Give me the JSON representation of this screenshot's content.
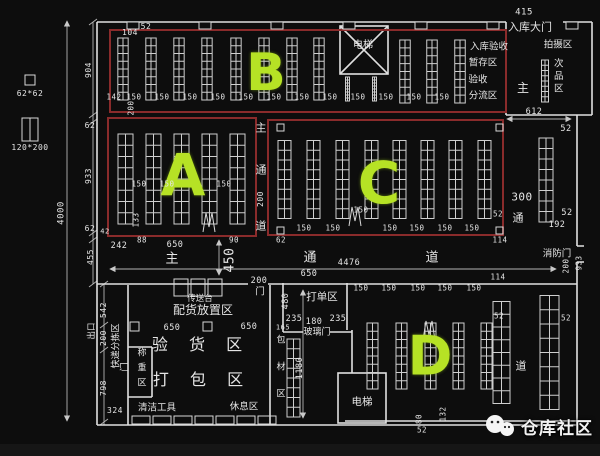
{
  "meta": {
    "description": "仓库平面图 (warehouse CAD floor plan)"
  },
  "colors": {
    "background": "#0d0d0d",
    "wall": "#e0e0e0",
    "rack": "#cfcfcf",
    "zone_border": "#8a2b2b",
    "zone_letter": "#b6e225",
    "text": "#e6e6e6"
  },
  "zones": {
    "a": "A",
    "b": "B",
    "c": "C",
    "d": "D"
  },
  "watermark": {
    "text": "仓库社区"
  },
  "legend": {
    "pillar": "62*62",
    "rack": "120*200"
  },
  "annotations": [
    {
      "n": "legend-pillar-size",
      "t": "62*62",
      "x": 30,
      "y": 94,
      "s": 8
    },
    {
      "n": "legend-rack-size",
      "t": "120*200",
      "x": 30,
      "y": 148,
      "s": 8
    },
    {
      "n": "dim-4000",
      "t": "4000",
      "x": 62,
      "y": 213,
      "r": -90,
      "s": 9
    },
    {
      "n": "dim-904",
      "t": "904",
      "x": 89,
      "y": 70,
      "r": -90,
      "s": 8
    },
    {
      "n": "dim-62-1",
      "t": "62",
      "x": 90,
      "y": 126,
      "s": 8
    },
    {
      "n": "dim-933",
      "t": "933",
      "x": 89,
      "y": 176,
      "r": -90,
      "s": 8
    },
    {
      "n": "dim-62-2",
      "t": "62",
      "x": 90,
      "y": 229,
      "s": 8
    },
    {
      "n": "dim-455",
      "t": "455",
      "x": 91,
      "y": 257,
      "r": -90,
      "s": 8
    },
    {
      "n": "dim-542",
      "t": "542",
      "x": 104,
      "y": 310,
      "r": -90,
      "s": 8
    },
    {
      "n": "dim-200-left",
      "t": "200",
      "x": 104,
      "y": 338,
      "r": -90,
      "s": 8
    },
    {
      "n": "dim-798",
      "t": "798",
      "x": 104,
      "y": 388,
      "r": -90,
      "s": 8
    },
    {
      "n": "dim-324",
      "t": "324",
      "x": 115,
      "y": 411,
      "s": 8
    },
    {
      "n": "label-exit",
      "t": "出口",
      "x": 92,
      "y": 331,
      "r": -90,
      "s": 8.5
    },
    {
      "n": "label-express-sorting-area",
      "t": "快递分拣区",
      "x": 117,
      "y": 346,
      "r": -90,
      "s": 9
    },
    {
      "n": "dim-104",
      "t": "104",
      "x": 130,
      "y": 33,
      "s": 8
    },
    {
      "n": "dim-52-top",
      "t": "52",
      "x": 146,
      "y": 27,
      "s": 8
    },
    {
      "n": "dim-415",
      "t": "415",
      "x": 524,
      "y": 13,
      "s": 9
    },
    {
      "n": "label-inbound-gate",
      "t": "入库大门",
      "x": 530,
      "y": 27,
      "s": 11
    },
    {
      "n": "label-elevator-top",
      "t": "电梯",
      "x": 363,
      "y": 46,
      "s": 10
    },
    {
      "n": "label-inbound-inspection",
      "t": "入库验收",
      "x": 489,
      "y": 47,
      "s": 9.5
    },
    {
      "n": "label-staging-area",
      "t": "暂存区",
      "x": 483,
      "y": 63,
      "s": 9.5
    },
    {
      "n": "label-inspection",
      "t": "验收",
      "x": 478,
      "y": 80,
      "s": 9.5
    },
    {
      "n": "label-distribution-area",
      "t": "分流区",
      "x": 483,
      "y": 96,
      "s": 9.5
    },
    {
      "n": "label-main-top",
      "t": "主",
      "x": 523,
      "y": 88,
      "s": 12
    },
    {
      "n": "label-photo-area",
      "t": "拍摄区",
      "x": 558,
      "y": 45,
      "s": 9.5
    },
    {
      "n": "label-defective-area",
      "t": "次品区",
      "x": 557,
      "y": 77,
      "s": 9.5,
      "v": true,
      "ls": 3
    },
    {
      "n": "dim-142",
      "t": "142",
      "x": 114,
      "y": 97,
      "s": 7.5
    },
    {
      "n": "b-150-1",
      "t": "150",
      "x": 134,
      "y": 97,
      "s": 7.5
    },
    {
      "n": "b-150-2",
      "t": "150",
      "x": 162,
      "y": 97,
      "s": 7.5
    },
    {
      "n": "b-150-3",
      "t": "150",
      "x": 190,
      "y": 97,
      "s": 7.5
    },
    {
      "n": "b-150-4",
      "t": "150",
      "x": 218,
      "y": 97,
      "s": 7.5
    },
    {
      "n": "b-150-5",
      "t": "150",
      "x": 246,
      "y": 97,
      "s": 7.5
    },
    {
      "n": "b-150-6",
      "t": "150",
      "x": 274,
      "y": 97,
      "s": 7.5
    },
    {
      "n": "b-150-7",
      "t": "150",
      "x": 302,
      "y": 97,
      "s": 7.5
    },
    {
      "n": "b-150-8",
      "t": "150",
      "x": 330,
      "y": 97,
      "s": 7.5
    },
    {
      "n": "b-150-9",
      "t": "150",
      "x": 358,
      "y": 97,
      "s": 7.5
    },
    {
      "n": "b-150-10",
      "t": "150",
      "x": 386,
      "y": 97,
      "s": 7.5
    },
    {
      "n": "b-150-11",
      "t": "150",
      "x": 414,
      "y": 97,
      "s": 7.5
    },
    {
      "n": "b-150-12",
      "t": "150",
      "x": 442,
      "y": 97,
      "s": 7.5
    },
    {
      "n": "dim-200-ba",
      "t": "200",
      "x": 131,
      "y": 108,
      "r": -90,
      "s": 7.5
    },
    {
      "n": "dim-133",
      "t": "133",
      "x": 136,
      "y": 220,
      "r": -90,
      "s": 7.5
    },
    {
      "n": "dim-42",
      "t": "42",
      "x": 105,
      "y": 232,
      "s": 7
    },
    {
      "n": "a-150-1",
      "t": "150",
      "x": 139,
      "y": 184,
      "s": 7.5
    },
    {
      "n": "a-150-2",
      "t": "150",
      "x": 167,
      "y": 184,
      "s": 7.5
    },
    {
      "n": "a-150-3",
      "t": "150",
      "x": 224,
      "y": 184,
      "s": 7.5
    },
    {
      "n": "dim-242",
      "t": "242",
      "x": 119,
      "y": 246,
      "s": 8.5
    },
    {
      "n": "dim-88",
      "t": "88",
      "x": 142,
      "y": 240,
      "s": 7.5
    },
    {
      "n": "dim-650-a",
      "t": "650",
      "x": 175,
      "y": 245,
      "s": 8.5
    },
    {
      "n": "dim-90",
      "t": "90",
      "x": 234,
      "y": 240,
      "s": 7.5
    },
    {
      "n": "dim-62-3",
      "t": "62",
      "x": 281,
      "y": 240,
      "s": 7.5
    },
    {
      "n": "dim-114-c",
      "t": "114",
      "x": 500,
      "y": 240,
      "s": 7.5
    },
    {
      "n": "label-main-aisle-zhu",
      "t": "主",
      "x": 172,
      "y": 259,
      "s": 13
    },
    {
      "n": "label-main-aisle-tong",
      "t": "通",
      "x": 310,
      "y": 258,
      "s": 13
    },
    {
      "n": "label-main-aisle-dao",
      "t": "道",
      "x": 432,
      "y": 258,
      "s": 13
    },
    {
      "n": "dim-4476",
      "t": "4476",
      "x": 349,
      "y": 263,
      "s": 8.5
    },
    {
      "n": "dim-450",
      "t": "450",
      "x": 230,
      "y": 260,
      "r": -90,
      "s": 13
    },
    {
      "n": "label-fire-door-right",
      "t": "消防门",
      "x": 557,
      "y": 254,
      "s": 9.5
    },
    {
      "n": "label-v-aisle-zhu",
      "t": "主",
      "x": 261,
      "y": 128,
      "s": 11
    },
    {
      "n": "label-v-aisle-tong",
      "t": "通",
      "x": 261,
      "y": 170,
      "s": 11
    },
    {
      "n": "dim-200-va",
      "t": "200",
      "x": 261,
      "y": 199,
      "r": -90,
      "s": 8
    },
    {
      "n": "label-v-aisle-dao",
      "t": "道",
      "x": 261,
      "y": 226,
      "s": 11
    },
    {
      "n": "c-150-1",
      "t": "150",
      "x": 304,
      "y": 228,
      "s": 7.5
    },
    {
      "n": "c-150-2",
      "t": "150",
      "x": 333,
      "y": 228,
      "s": 7.5
    },
    {
      "n": "c-150-3",
      "t": "150",
      "x": 361,
      "y": 210,
      "s": 7.5
    },
    {
      "n": "c-150-4",
      "t": "150",
      "x": 390,
      "y": 228,
      "s": 7.5
    },
    {
      "n": "c-150-5",
      "t": "150",
      "x": 417,
      "y": 228,
      "s": 7.5
    },
    {
      "n": "c-150-6",
      "t": "150",
      "x": 445,
      "y": 228,
      "s": 7.5
    },
    {
      "n": "c-150-7",
      "t": "150",
      "x": 472,
      "y": 228,
      "s": 7.5
    },
    {
      "n": "c-52",
      "t": "52",
      "x": 498,
      "y": 214,
      "s": 7.5
    },
    {
      "n": "dim-612",
      "t": "612",
      "x": 534,
      "y": 112,
      "s": 8.5
    },
    {
      "n": "dim-52-r1",
      "t": "52",
      "x": 566,
      "y": 129,
      "s": 8.5
    },
    {
      "n": "dim-300",
      "t": "300",
      "x": 522,
      "y": 197,
      "s": 11
    },
    {
      "n": "label-right-aisle-tong",
      "t": "通",
      "x": 518,
      "y": 218,
      "s": 11
    },
    {
      "n": "dim-52-r2",
      "t": "52",
      "x": 567,
      "y": 213,
      "s": 8.5
    },
    {
      "n": "dim-192",
      "t": "192",
      "x": 557,
      "y": 225,
      "s": 8.5
    },
    {
      "n": "dim-200-r",
      "t": "200",
      "x": 566,
      "y": 266,
      "r": -90,
      "s": 7.5
    },
    {
      "n": "dim-933-r",
      "t": "933",
      "x": 579,
      "y": 263,
      "r": -90,
      "s": 7.5
    },
    {
      "n": "label-conveyor",
      "t": "传送台",
      "x": 200,
      "y": 299,
      "s": 8.5
    },
    {
      "n": "label-allocation-area",
      "t": "配货放置区",
      "x": 203,
      "y": 310,
      "s": 12
    },
    {
      "n": "dim-650-b1",
      "t": "650",
      "x": 172,
      "y": 328,
      "s": 8.5
    },
    {
      "n": "dim-650-b2",
      "t": "650",
      "x": 249,
      "y": 327,
      "s": 8.5
    },
    {
      "n": "label-goods-inspection-area",
      "t": "验 货 区",
      "x": 201,
      "y": 345,
      "s": 16,
      "ls": 8
    },
    {
      "n": "label-packing-area",
      "t": "打 包 区",
      "x": 202,
      "y": 380,
      "s": 16,
      "ls": 8
    },
    {
      "n": "label-weigh-door",
      "t": "门",
      "x": 126,
      "y": 367,
      "r": -90,
      "s": 9
    },
    {
      "n": "label-weighing-area",
      "t": "称重区",
      "x": 140,
      "y": 370,
      "s": 9,
      "v": true,
      "ls": 6
    },
    {
      "n": "label-cleaning-tools",
      "t": "清洁工具",
      "x": 157,
      "y": 408,
      "s": 9.5
    },
    {
      "n": "label-rest-area",
      "t": "休息区",
      "x": 244,
      "y": 407,
      "s": 9.5
    },
    {
      "n": "dim-200-door",
      "t": "200",
      "x": 259,
      "y": 281,
      "s": 8.5
    },
    {
      "n": "label-door-main",
      "t": "门",
      "x": 260,
      "y": 292,
      "s": 9.5
    },
    {
      "n": "dim-650-c",
      "t": "650",
      "x": 309,
      "y": 274,
      "s": 8.5
    },
    {
      "n": "label-order-printing-area",
      "t": "打单区",
      "x": 322,
      "y": 297,
      "s": 10.5
    },
    {
      "n": "dim-480",
      "t": "480",
      "x": 286,
      "y": 301,
      "r": -90,
      "s": 8.5
    },
    {
      "n": "dim-235-1",
      "t": "235",
      "x": 294,
      "y": 319,
      "s": 8.5
    },
    {
      "n": "dim-180",
      "t": "180",
      "x": 314,
      "y": 322,
      "s": 8.5
    },
    {
      "n": "dim-235-2",
      "t": "235",
      "x": 338,
      "y": 319,
      "s": 8.5
    },
    {
      "n": "dim-165",
      "t": "165",
      "x": 283,
      "y": 328,
      "s": 7
    },
    {
      "n": "label-glass-door",
      "t": "玻璃门",
      "x": 317,
      "y": 333,
      "s": 9
    },
    {
      "n": "label-packing-material-area",
      "t": "包材区",
      "x": 279,
      "y": 375,
      "s": 9,
      "v": true,
      "ls": 18
    },
    {
      "n": "dim-1180",
      "t": "1180",
      "x": 300,
      "y": 368,
      "r": -90,
      "s": 8.5
    },
    {
      "n": "label-elevator-bottom",
      "t": "电梯",
      "x": 362,
      "y": 402,
      "s": 10.5
    },
    {
      "n": "d-150-1",
      "t": "150",
      "x": 361,
      "y": 288,
      "s": 7.5
    },
    {
      "n": "d-150-2",
      "t": "150",
      "x": 389,
      "y": 288,
      "s": 7.5
    },
    {
      "n": "d-150-3",
      "t": "150",
      "x": 418,
      "y": 288,
      "s": 7.5
    },
    {
      "n": "d-150-4",
      "t": "150",
      "x": 445,
      "y": 288,
      "s": 7.5
    },
    {
      "n": "d-150-5",
      "t": "150",
      "x": 474,
      "y": 288,
      "s": 7.5
    },
    {
      "n": "dim-114-d",
      "t": "114",
      "x": 498,
      "y": 277,
      "s": 7.5
    },
    {
      "n": "dim-52-d1",
      "t": "52",
      "x": 499,
      "y": 316,
      "s": 7.5
    },
    {
      "n": "dim-52-d2",
      "t": "52",
      "x": 566,
      "y": 318,
      "s": 7.5
    },
    {
      "n": "label-right-aisle-dao",
      "t": "道",
      "x": 521,
      "y": 366,
      "s": 11
    },
    {
      "n": "dim-80",
      "t": "80",
      "x": 419,
      "y": 419,
      "r": -90,
      "s": 7.5
    },
    {
      "n": "dim-132",
      "t": "132",
      "x": 443,
      "y": 414,
      "r": -90,
      "s": 7.5
    },
    {
      "n": "dim-52-d3",
      "t": "52",
      "x": 422,
      "y": 430,
      "s": 7.5
    }
  ]
}
